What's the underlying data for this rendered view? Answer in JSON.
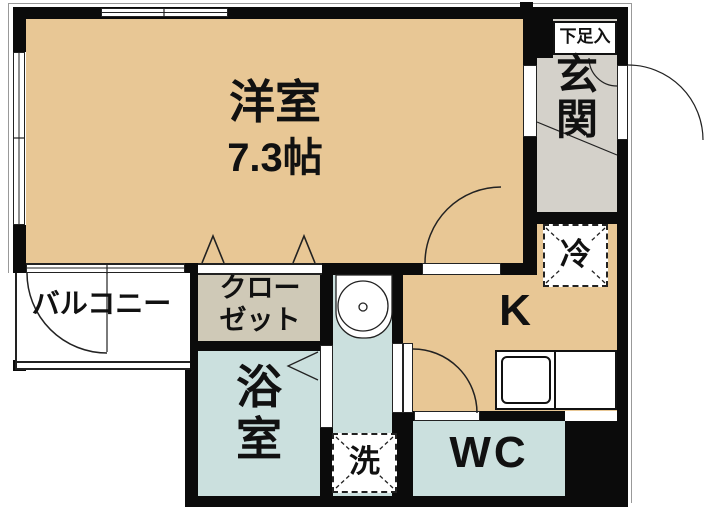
{
  "colors": {
    "wall": "#0b0b0b",
    "room_tan": "#e8c795",
    "genkan_gray": "#d4d1ca",
    "closet_beige": "#cfc9b7",
    "wet_teal": "#cbe0de",
    "line": "#222222"
  },
  "rooms": {
    "living": {
      "name": "洋室",
      "size": "7.3帖"
    },
    "genkan": {
      "line1": "玄",
      "line2": "関"
    },
    "shoe_cabinet": {
      "name": "下足入"
    },
    "refrigerator": {
      "name": "冷"
    },
    "kitchen": {
      "name": "K"
    },
    "balcony": {
      "name": "バルコニー"
    },
    "closet": {
      "line1": "クロー",
      "line2": "ゼット"
    },
    "bath": {
      "line1": "浴",
      "line2": "室"
    },
    "laundry": {
      "name": "洗"
    },
    "wc": {
      "name": "WC"
    }
  }
}
